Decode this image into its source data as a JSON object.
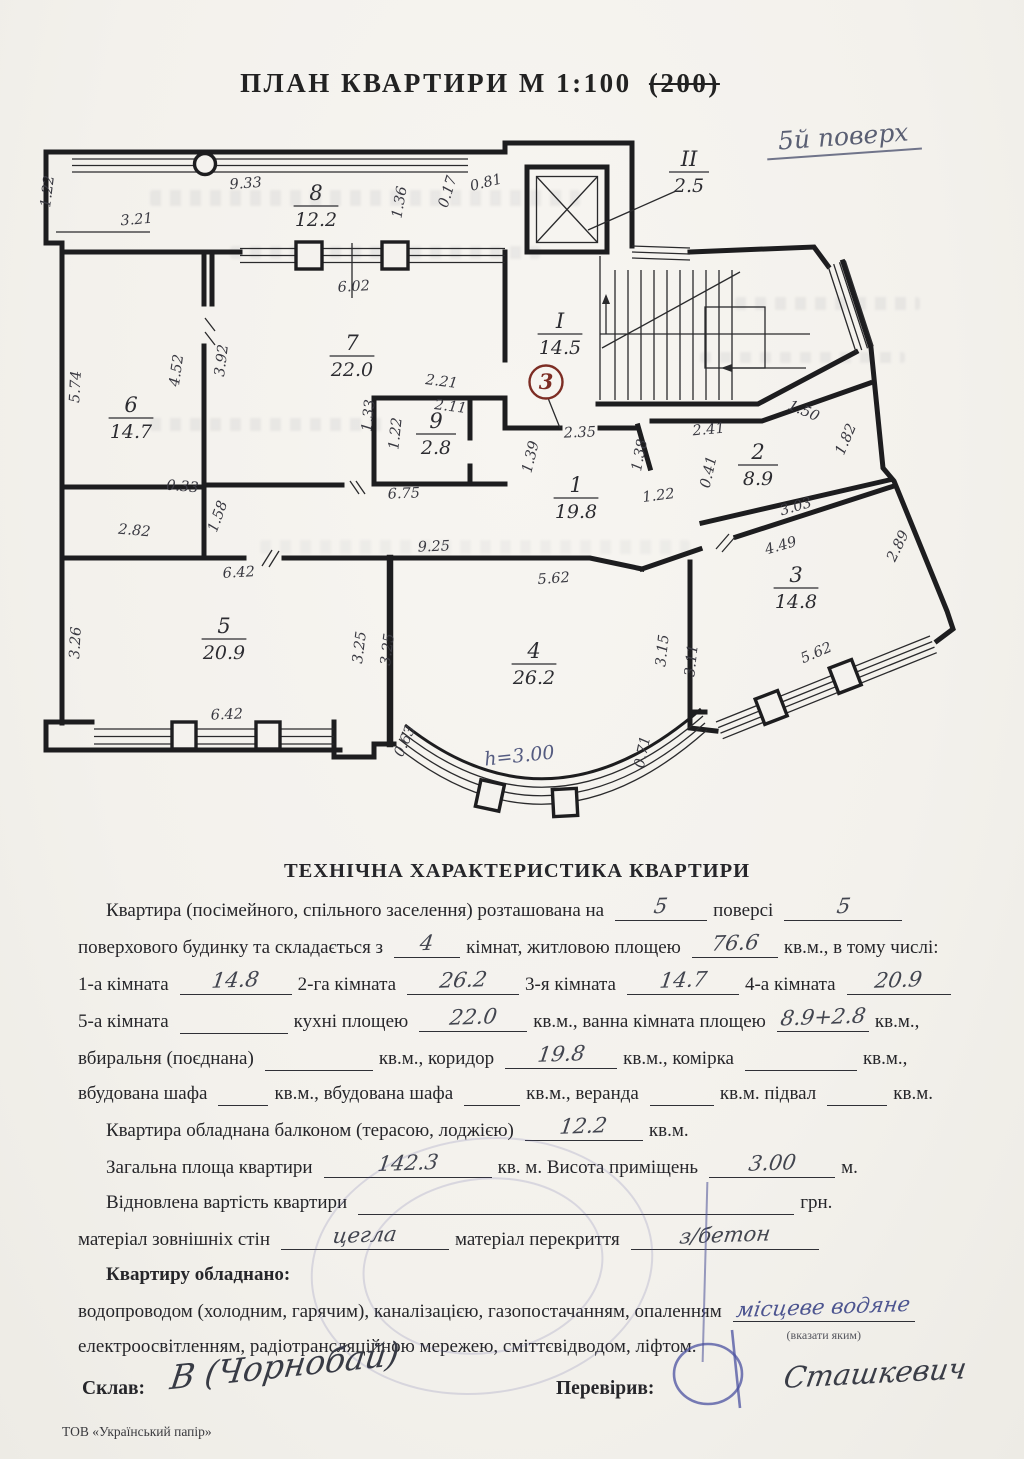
{
  "colors": {
    "paper": "#f4f2ee",
    "wall": "#1d1d1f",
    "pencil_ink": "#42454f",
    "blue_ink": "#4d5590",
    "red_mark": "#7d2d24"
  },
  "page": {
    "title": "ПЛАН  КВАРТИРИ  М   1:100",
    "title_struck": "(200)",
    "floor_note": "5й поверх",
    "footer": "ТОВ «Український  папір»"
  },
  "plan": {
    "rooms": [
      {
        "num": "8",
        "area": "12.2",
        "x": 316,
        "y": 200
      },
      {
        "num": "6",
        "area": "14.7",
        "x": 131,
        "y": 412
      },
      {
        "num": "7",
        "area": "22.0",
        "x": 352,
        "y": 350
      },
      {
        "num": "9",
        "area": "2.8",
        "x": 436,
        "y": 428
      },
      {
        "num": "1",
        "area": "19.8",
        "x": 576,
        "y": 492
      },
      {
        "num": "5",
        "area": "20.9",
        "x": 224,
        "y": 633
      },
      {
        "num": "4",
        "area": "26.2",
        "x": 534,
        "y": 658
      },
      {
        "num": "2",
        "area": "8.9",
        "x": 758,
        "y": 459
      },
      {
        "num": "3",
        "area": "14.8",
        "x": 796,
        "y": 582
      },
      {
        "num": "I",
        "area": "14.5",
        "x": 560,
        "y": 328
      },
      {
        "num": "II",
        "area": "2.5",
        "x": 689,
        "y": 166
      }
    ],
    "dims": [
      {
        "t": "1.22",
        "x": 52,
        "y": 192,
        "r": -83
      },
      {
        "t": "9.33",
        "x": 246,
        "y": 188,
        "r": -4
      },
      {
        "t": "3.21",
        "x": 137,
        "y": 224,
        "r": -5
      },
      {
        "t": "1.36",
        "x": 404,
        "y": 203,
        "r": -80
      },
      {
        "t": "0.17",
        "x": 452,
        "y": 193,
        "r": -73
      },
      {
        "t": "0.81",
        "x": 487,
        "y": 187,
        "r": -14
      },
      {
        "t": "6.02",
        "x": 354,
        "y": 291,
        "r": -3
      },
      {
        "t": "5.74",
        "x": 80,
        "y": 387,
        "r": -87
      },
      {
        "t": "4.52",
        "x": 181,
        "y": 371,
        "r": -82
      },
      {
        "t": "3.92",
        "x": 226,
        "y": 361,
        "r": -83
      },
      {
        "t": "2.21",
        "x": 441,
        "y": 386,
        "r": 7
      },
      {
        "t": "2.11",
        "x": 450,
        "y": 411,
        "r": 7
      },
      {
        "t": "1.33",
        "x": 373,
        "y": 416,
        "r": -84
      },
      {
        "t": "1.22",
        "x": 400,
        "y": 434,
        "r": -84
      },
      {
        "t": "0.33",
        "x": 182,
        "y": 491,
        "r": 5
      },
      {
        "t": "1.58",
        "x": 222,
        "y": 518,
        "r": -70
      },
      {
        "t": "2.82",
        "x": 134,
        "y": 535,
        "r": 5
      },
      {
        "t": "6.75",
        "x": 404,
        "y": 498,
        "r": -2
      },
      {
        "t": "2.35",
        "x": 580,
        "y": 437,
        "r": -2
      },
      {
        "t": "1.39",
        "x": 535,
        "y": 458,
        "r": -76
      },
      {
        "t": "1.38",
        "x": 644,
        "y": 456,
        "r": -79
      },
      {
        "t": "2.41",
        "x": 709,
        "y": 434,
        "r": -5
      },
      {
        "t": "1.50",
        "x": 802,
        "y": 415,
        "r": 23
      },
      {
        "t": "1.82",
        "x": 850,
        "y": 441,
        "r": -67
      },
      {
        "t": "0.41",
        "x": 713,
        "y": 473,
        "r": -77
      },
      {
        "t": "1.22",
        "x": 659,
        "y": 500,
        "r": -7
      },
      {
        "t": "3.03",
        "x": 797,
        "y": 511,
        "r": -16
      },
      {
        "t": "4.49",
        "x": 782,
        "y": 550,
        "r": -16
      },
      {
        "t": "2.89",
        "x": 902,
        "y": 548,
        "r": -64
      },
      {
        "t": "5.62",
        "x": 554,
        "y": 583,
        "r": -4
      },
      {
        "t": "6.42",
        "x": 239,
        "y": 577,
        "r": -3
      },
      {
        "t": "9.25",
        "x": 434,
        "y": 551,
        "r": -2
      },
      {
        "t": "3.26",
        "x": 80,
        "y": 643,
        "r": -87
      },
      {
        "t": "3.25",
        "x": 364,
        "y": 648,
        "r": -83
      },
      {
        "t": "3.25",
        "x": 392,
        "y": 650,
        "r": -83
      },
      {
        "t": "6.42",
        "x": 227,
        "y": 719,
        "r": -2
      },
      {
        "t": "0.63",
        "x": 409,
        "y": 743,
        "r": -66
      },
      {
        "t": "3.15",
        "x": 667,
        "y": 651,
        "r": -84
      },
      {
        "t": "3.11",
        "x": 696,
        "y": 661,
        "r": -84
      },
      {
        "t": "5.62",
        "x": 818,
        "y": 657,
        "r": -23
      },
      {
        "t": "0.71",
        "x": 647,
        "y": 753,
        "r": -78
      }
    ],
    "height_note": {
      "t": "h=3.00",
      "x": 520,
      "y": 762,
      "r": -6
    },
    "entrance_mark": {
      "t": "3",
      "x": 546,
      "y": 382
    }
  },
  "form": {
    "title": "ТЕХНІЧНА  ХАРАКТЕРИСТИКА КВАРТИРИ",
    "lines": [
      {
        "indent": true,
        "parts": [
          {
            "t": "Квартира (посімейного, спільного заселення) розташована на"
          },
          {
            "b": {
              "v": "5",
              "w": 92
            }
          },
          {
            "t": "поверсі"
          },
          {
            "b": {
              "v": "5",
              "w": 118
            }
          }
        ]
      },
      {
        "parts": [
          {
            "t": "поверхового будинку та складається з"
          },
          {
            "b": {
              "v": "4",
              "w": 66
            }
          },
          {
            "t": "кімнат, житловою площею"
          },
          {
            "b": {
              "v": "76.6",
              "w": 86
            }
          },
          {
            "t": "кв.м., в тому числі:"
          }
        ]
      },
      {
        "parts": [
          {
            "t": "1-а кімната"
          },
          {
            "b": {
              "v": "14.8",
              "w": 112
            }
          },
          {
            "t": "2-га кімната"
          },
          {
            "b": {
              "v": "26.2",
              "w": 112
            }
          },
          {
            "t": "3-я кімната"
          },
          {
            "b": {
              "v": "14.7",
              "w": 112
            }
          },
          {
            "t": "4-а кімната"
          },
          {
            "b": {
              "v": "20.9",
              "w": 104
            }
          }
        ]
      },
      {
        "parts": [
          {
            "t": "5-а кімната"
          },
          {
            "b": {
              "v": "",
              "w": 108
            }
          },
          {
            "t": "кухні площею"
          },
          {
            "b": {
              "v": "22.0",
              "w": 108
            }
          },
          {
            "t": "кв.м., ванна кімната площею"
          },
          {
            "b": {
              "v": "8.9+2.8",
              "w": 92
            }
          },
          {
            "t": "кв.м.,"
          }
        ]
      },
      {
        "parts": [
          {
            "t": "вбиральня (поєднана)"
          },
          {
            "b": {
              "v": "",
              "w": 108
            }
          },
          {
            "t": "кв.м., коридор"
          },
          {
            "b": {
              "v": "19.8",
              "w": 112
            }
          },
          {
            "t": "кв.м., комірка"
          },
          {
            "b": {
              "v": "",
              "w": 112
            }
          },
          {
            "t": "кв.м.,"
          }
        ]
      },
      {
        "parts": [
          {
            "t": "вбудована шафа"
          },
          {
            "b": {
              "v": "",
              "w": 50
            }
          },
          {
            "t": "кв.м., вбудована шафа"
          },
          {
            "b": {
              "v": "",
              "w": 56
            }
          },
          {
            "t": "кв.м., веранда"
          },
          {
            "b": {
              "v": "",
              "w": 64
            }
          },
          {
            "t": "кв.м. підвал"
          },
          {
            "b": {
              "v": "",
              "w": 60
            }
          },
          {
            "t": "кв.м."
          }
        ]
      },
      {
        "indent": true,
        "parts": [
          {
            "t": "Квартира обладнана балконом (терасою, лоджією)"
          },
          {
            "b": {
              "v": "12.2",
              "w": 118
            }
          },
          {
            "t": "кв.м."
          }
        ]
      },
      {
        "indent": true,
        "parts": [
          {
            "t": "Загальна площа квартири"
          },
          {
            "b": {
              "v": "142.3",
              "w": 168
            }
          },
          {
            "t": "кв. м. Висота приміщень"
          },
          {
            "b": {
              "v": "3.00",
              "w": 126
            }
          },
          {
            "t": "м."
          }
        ]
      },
      {
        "indent": true,
        "parts": [
          {
            "t": "Відновлена вартість квартири"
          },
          {
            "b": {
              "v": "",
              "w": 436
            }
          },
          {
            "t": "грн."
          }
        ]
      },
      {
        "parts": [
          {
            "t": "матеріал зовнішніх стін"
          },
          {
            "b": {
              "v": "цегла",
              "w": 168
            }
          },
          {
            "t": "матеріал перекриття"
          },
          {
            "b": {
              "v": "з/бетон",
              "w": 188
            }
          }
        ]
      },
      {
        "indent": true,
        "bold": true,
        "parts": [
          {
            "t": "Квартиру обладнано:"
          }
        ]
      },
      {
        "parts": [
          {
            "t": "водопроводом (холодним, гарячим), каналізацією, газопостачанням, опаленням"
          },
          {
            "b": {
              "v": "місцеве водяне",
              "w": 182,
              "ink": "blue",
              "note": "(вказати яким)"
            }
          }
        ]
      },
      {
        "parts": [
          {
            "t": "електроосвітленням, радіотрансляційною мережею, сміттєвідводом, ліфтом."
          }
        ]
      }
    ],
    "signatures": {
      "made_label": "Склав:",
      "made_sig": "В (Чорнобай)",
      "checked_label": "Перевірив:",
      "checked_sig": "Сташкевич"
    }
  }
}
